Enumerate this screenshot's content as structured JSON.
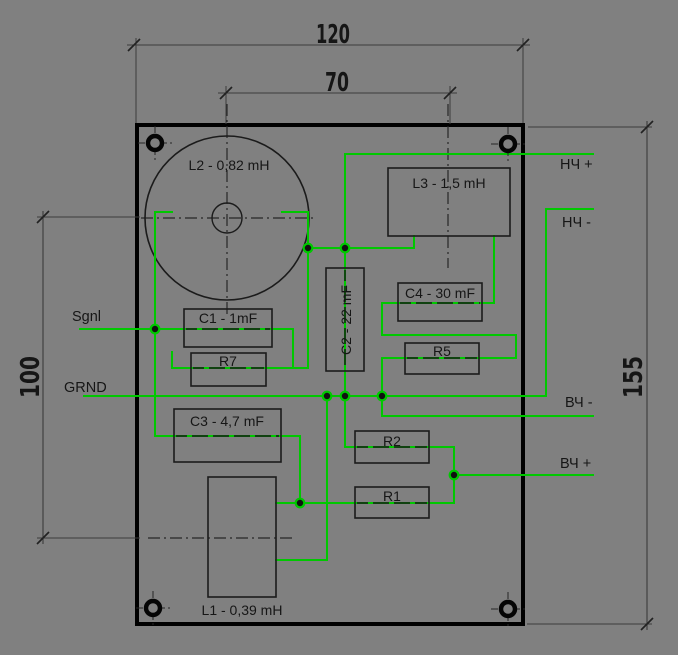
{
  "title": "speaker-crossover-board-drawing",
  "colors": {
    "background": "#808080",
    "line": "#1b1b1b",
    "dim_line": "#3c3c3c",
    "trace_green": "#00c800",
    "dot_fill": "#101010",
    "text": "#161616"
  },
  "board": {
    "x": 137,
    "y": 125,
    "width": 386,
    "height": 499,
    "stroke_width": 4
  },
  "dimensions": [
    {
      "name": "dim-120",
      "label": "120",
      "line": [
        127,
        45,
        530,
        45
      ],
      "ticks": [
        [
          134,
          45
        ],
        [
          523,
          45
        ]
      ],
      "ext": [
        [
          136,
          38,
          136,
          123
        ],
        [
          523,
          38,
          523,
          123
        ]
      ],
      "text": {
        "x": 333,
        "y": 43,
        "rotate": 0,
        "length": 34
      }
    },
    {
      "name": "dim-70",
      "label": "70",
      "line": [
        218,
        93,
        457,
        93
      ],
      "ticks": [
        [
          226,
          93
        ],
        [
          450,
          93
        ]
      ],
      "ext": [
        [
          226,
          86,
          226,
          124
        ],
        [
          450,
          86,
          450,
          124
        ]
      ],
      "text": {
        "x": 337,
        "y": 91,
        "rotate": 0,
        "length": 24
      }
    },
    {
      "name": "dim-100",
      "label": "100",
      "line": [
        43,
        211,
        43,
        544
      ],
      "ticks": [
        [
          43,
          217
        ],
        [
          43,
          538
        ]
      ],
      "ext": [
        [
          37,
          217,
          140,
          217
        ],
        [
          37,
          538,
          140,
          538
        ]
      ],
      "text": {
        "x": 39,
        "y": 377,
        "rotate": -90,
        "length": 42
      }
    },
    {
      "name": "dim-155",
      "label": "155",
      "line": [
        647,
        121,
        647,
        630
      ],
      "ticks": [
        [
          647,
          127
        ],
        [
          647,
          624
        ]
      ],
      "ext": [
        [
          528,
          127,
          652,
          127
        ],
        [
          527,
          624,
          652,
          624
        ]
      ],
      "text": {
        "x": 642,
        "y": 377,
        "rotate": -90,
        "length": 42
      }
    }
  ],
  "centerlines": [
    {
      "name": "centerline-L2-horizontal",
      "points": [
        141,
        218,
        315,
        218
      ]
    },
    {
      "name": "centerline-L2-vertical",
      "points": [
        227,
        104,
        227,
        318
      ]
    },
    {
      "name": "centerline-L3-vertical",
      "points": [
        448,
        104,
        448,
        268
      ]
    },
    {
      "name": "centerline-L1-horizontal",
      "points": [
        148,
        538,
        296,
        538
      ]
    }
  ],
  "inductor_circle": {
    "cx": 227,
    "cy": 218,
    "r_outer": 82,
    "r_inner": 15
  },
  "components": [
    {
      "name": "L2",
      "label": "L2 - 0,82 mH",
      "rect": null,
      "text": {
        "x": 229,
        "y": 170,
        "rotate": 0
      }
    },
    {
      "name": "L3",
      "label": "L3 - 1,5 mH",
      "rect": [
        388,
        168,
        122,
        68
      ],
      "text": {
        "x": 449,
        "y": 188,
        "rotate": 0
      }
    },
    {
      "name": "C1",
      "label": "C1 - 1mF",
      "rect": [
        184,
        309,
        88,
        38
      ],
      "text": {
        "x": 228,
        "y": 323,
        "rotate": 0
      }
    },
    {
      "name": "R7",
      "label": "R7",
      "rect": [
        191,
        353,
        75,
        33
      ],
      "text": {
        "x": 228,
        "y": 366,
        "rotate": 0
      }
    },
    {
      "name": "C2",
      "label": "C2 - 22 mF",
      "rect": [
        326,
        268,
        38,
        103
      ],
      "text": {
        "x": 351,
        "y": 320,
        "rotate": -90
      }
    },
    {
      "name": "C4",
      "label": "C4 - 30 mF",
      "rect": [
        398,
        283,
        84,
        38
      ],
      "text": {
        "x": 440,
        "y": 298,
        "rotate": 0
      }
    },
    {
      "name": "R5",
      "label": "R5",
      "rect": [
        405,
        343,
        74,
        31
      ],
      "text": {
        "x": 442,
        "y": 356,
        "rotate": 0
      }
    },
    {
      "name": "C3",
      "label": "C3 - 4,7 mF",
      "rect": [
        174,
        409,
        107,
        53
      ],
      "text": {
        "x": 227,
        "y": 426,
        "rotate": 0
      }
    },
    {
      "name": "R2",
      "label": "R2",
      "rect": [
        355,
        431,
        74,
        32
      ],
      "text": {
        "x": 392,
        "y": 446,
        "rotate": 0
      }
    },
    {
      "name": "R1",
      "label": "R1",
      "rect": [
        355,
        487,
        74,
        31
      ],
      "text": {
        "x": 392,
        "y": 501,
        "rotate": 0
      }
    },
    {
      "name": "L1",
      "label": "L1 - 0,39 mH",
      "rect": [
        208,
        477,
        68,
        120
      ],
      "text": {
        "x": 242,
        "y": 615,
        "rotate": 0
      }
    }
  ],
  "terminals": [
    {
      "name": "terminal-sgnl",
      "label": "Sgnl",
      "text": {
        "x": 72,
        "y": 321
      }
    },
    {
      "name": "terminal-grnd",
      "label": "GRND",
      "text": {
        "x": 64,
        "y": 392
      }
    },
    {
      "name": "terminal-nch-plus",
      "label": "НЧ +",
      "text": {
        "x": 560,
        "y": 169
      }
    },
    {
      "name": "terminal-nch-minus",
      "label": "НЧ -",
      "text": {
        "x": 562,
        "y": 227
      }
    },
    {
      "name": "terminal-vch-minus",
      "label": "ВЧ -",
      "text": {
        "x": 565,
        "y": 407
      }
    },
    {
      "name": "terminal-vch-plus",
      "label": "ВЧ +",
      "text": {
        "x": 560,
        "y": 468
      }
    }
  ],
  "wires": [
    {
      "name": "wire-sgnl-lead",
      "points": [
        [
          80,
          329
        ],
        [
          155,
          329
        ]
      ]
    },
    {
      "name": "wire-l2-left-to-c3",
      "points": [
        [
          172,
          212
        ],
        [
          155,
          212
        ],
        [
          155,
          436
        ],
        [
          300,
          436
        ],
        [
          300,
          503
        ]
      ]
    },
    {
      "name": "wire-l2-right-lead",
      "points": [
        [
          282,
          212
        ],
        [
          308,
          212
        ],
        [
          308,
          248
        ]
      ]
    },
    {
      "name": "wire-c1-link",
      "points": [
        [
          155,
          329
        ],
        [
          293,
          329
        ],
        [
          293,
          368
        ]
      ]
    },
    {
      "name": "wire-r7-link",
      "points": [
        [
          172,
          352
        ],
        [
          172,
          368
        ],
        [
          308,
          368
        ],
        [
          308,
          248
        ]
      ]
    },
    {
      "name": "wire-top-dots-bridge",
      "points": [
        [
          308,
          248
        ],
        [
          345,
          248
        ]
      ]
    },
    {
      "name": "wire-nch-plus-line",
      "points": [
        [
          345,
          248
        ],
        [
          345,
          154
        ],
        [
          593,
          154
        ]
      ]
    },
    {
      "name": "wire-c2-line",
      "points": [
        [
          345,
          248
        ],
        [
          345,
          396
        ]
      ]
    },
    {
      "name": "wire-l3-left-lead",
      "points": [
        [
          345,
          248
        ],
        [
          414,
          248
        ],
        [
          414,
          236
        ]
      ]
    },
    {
      "name": "wire-l3-right-lead",
      "points": [
        [
          494,
          236
        ],
        [
          494,
          303
        ],
        [
          482,
          303
        ]
      ]
    },
    {
      "name": "wire-c4-r5-loop",
      "points": [
        [
          482,
          303
        ],
        [
          382,
          303
        ],
        [
          382,
          335
        ],
        [
          516,
          335
        ],
        [
          516,
          358
        ],
        [
          382,
          358
        ],
        [
          382,
          396
        ]
      ]
    },
    {
      "name": "wire-grnd-rail",
      "points": [
        [
          84,
          396
        ],
        [
          546,
          396
        ],
        [
          546,
          209
        ],
        [
          593,
          209
        ]
      ]
    },
    {
      "name": "wire-vch-minus-line",
      "points": [
        [
          382,
          396
        ],
        [
          382,
          416
        ],
        [
          593,
          416
        ]
      ]
    },
    {
      "name": "wire-r2-r1-chain",
      "points": [
        [
          345,
          396
        ],
        [
          345,
          447
        ],
        [
          454,
          447
        ],
        [
          454,
          503
        ],
        [
          276,
          503
        ]
      ]
    },
    {
      "name": "wire-vch-plus-line",
      "points": [
        [
          454,
          475
        ],
        [
          593,
          475
        ]
      ]
    },
    {
      "name": "wire-l1-lower-lead",
      "points": [
        [
          327,
          396
        ],
        [
          327,
          560
        ],
        [
          276,
          560
        ]
      ]
    }
  ],
  "hidden_segments": [
    {
      "name": "hidden-under-C1",
      "points": [
        186,
        329,
        270,
        329
      ]
    },
    {
      "name": "hidden-under-R7",
      "points": [
        193,
        368,
        264,
        368
      ]
    },
    {
      "name": "hidden-under-C2",
      "points": [
        345,
        270,
        345,
        369
      ]
    },
    {
      "name": "hidden-under-C3",
      "points": [
        176,
        436,
        279,
        436
      ]
    },
    {
      "name": "hidden-under-C4",
      "points": [
        400,
        303,
        480,
        303
      ]
    },
    {
      "name": "hidden-under-R5",
      "points": [
        407,
        358,
        477,
        358
      ]
    },
    {
      "name": "hidden-under-R2",
      "points": [
        357,
        447,
        427,
        447
      ]
    },
    {
      "name": "hidden-under-R1",
      "points": [
        357,
        503,
        427,
        503
      ]
    }
  ],
  "junction_dots": [
    [
      155,
      329
    ],
    [
      308,
      248
    ],
    [
      345,
      248
    ],
    [
      327,
      396
    ],
    [
      345,
      396
    ],
    [
      382,
      396
    ],
    [
      300,
      503
    ],
    [
      454,
      475
    ]
  ],
  "mounting_holes": [
    [
      155,
      143
    ],
    [
      508,
      144
    ],
    [
      153,
      608
    ],
    [
      508,
      609
    ]
  ]
}
